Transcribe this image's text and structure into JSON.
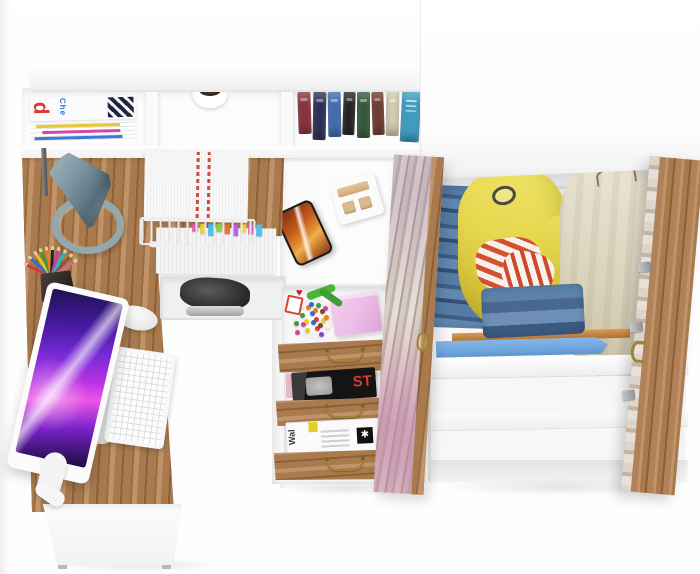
{
  "texts": {
    "magazine_letter": "d",
    "magazine_title": "Che",
    "black_magazine_caption": "ST",
    "wallpaper_spine": "Wal",
    "wallpaper_logo": "✱",
    "heart_glyph": "♥"
  },
  "colors": {
    "oak": "#a87a4e",
    "oak_dark": "#8f6038",
    "oak_light": "#c09468",
    "whitewash": "#d5cabf",
    "lamp_gray_blue": "#7c95a0",
    "screen_violet": "#7b2bd8",
    "screen_magenta": "#ee55e8",
    "phone_orange": "#e08a2f",
    "jacket_yellow": "#e6d74e",
    "coat_beige": "#ded6c1",
    "denim_blue": "#4c72a0",
    "stripe_red": "#d4512f",
    "pink_box": "#ecbce6",
    "board_blue": "#6fa7de",
    "brass": "#9c8434",
    "magazine_red": "#d93a2e",
    "magazine_blue": "#2a6fd4"
  },
  "shelf": {
    "book_colors": [
      "#8c3038",
      "#2a2d55",
      "#3f6db2",
      "#1f1f22",
      "#31593a",
      "#6e3a2e",
      "#d9cfb5",
      "#3e9dc2"
    ]
  },
  "desk": {
    "pencil_colors": [
      "#d23b30",
      "#2a6fd4",
      "#e8c22a",
      "#3a9a3a",
      "#e87f22",
      "#222222",
      "#c43bb0",
      "#2ab8c8",
      "#8a5a2a",
      "#d46a8a"
    ]
  },
  "documents": {
    "tab_colors": [
      "#e85fb0",
      "#f0d23a",
      "#4fc0e8",
      "#8fd04a",
      "#e8703a",
      "#c05fe8",
      "#f0d23a",
      "#e85fb0",
      "#4fc0e8"
    ]
  },
  "drawers": {
    "candy_colors": [
      "#e23a3a",
      "#f0c928",
      "#3f9d3a",
      "#2f6fd0",
      "#e87f1f",
      "#d63fa8",
      "#8a3fd0",
      "#f5f5f5",
      "#7a4a1f",
      "#e23a3a",
      "#2f6fd0",
      "#f0c928",
      "#3f9d3a",
      "#d63fa8",
      "#e87f1f",
      "#8a3fd0",
      "#e23a3a",
      "#2f6fd0",
      "#f0c928",
      "#f5f5f5",
      "#3f9d3a",
      "#d63fa8",
      "#7a4a1f",
      "#e87f1f"
    ]
  }
}
